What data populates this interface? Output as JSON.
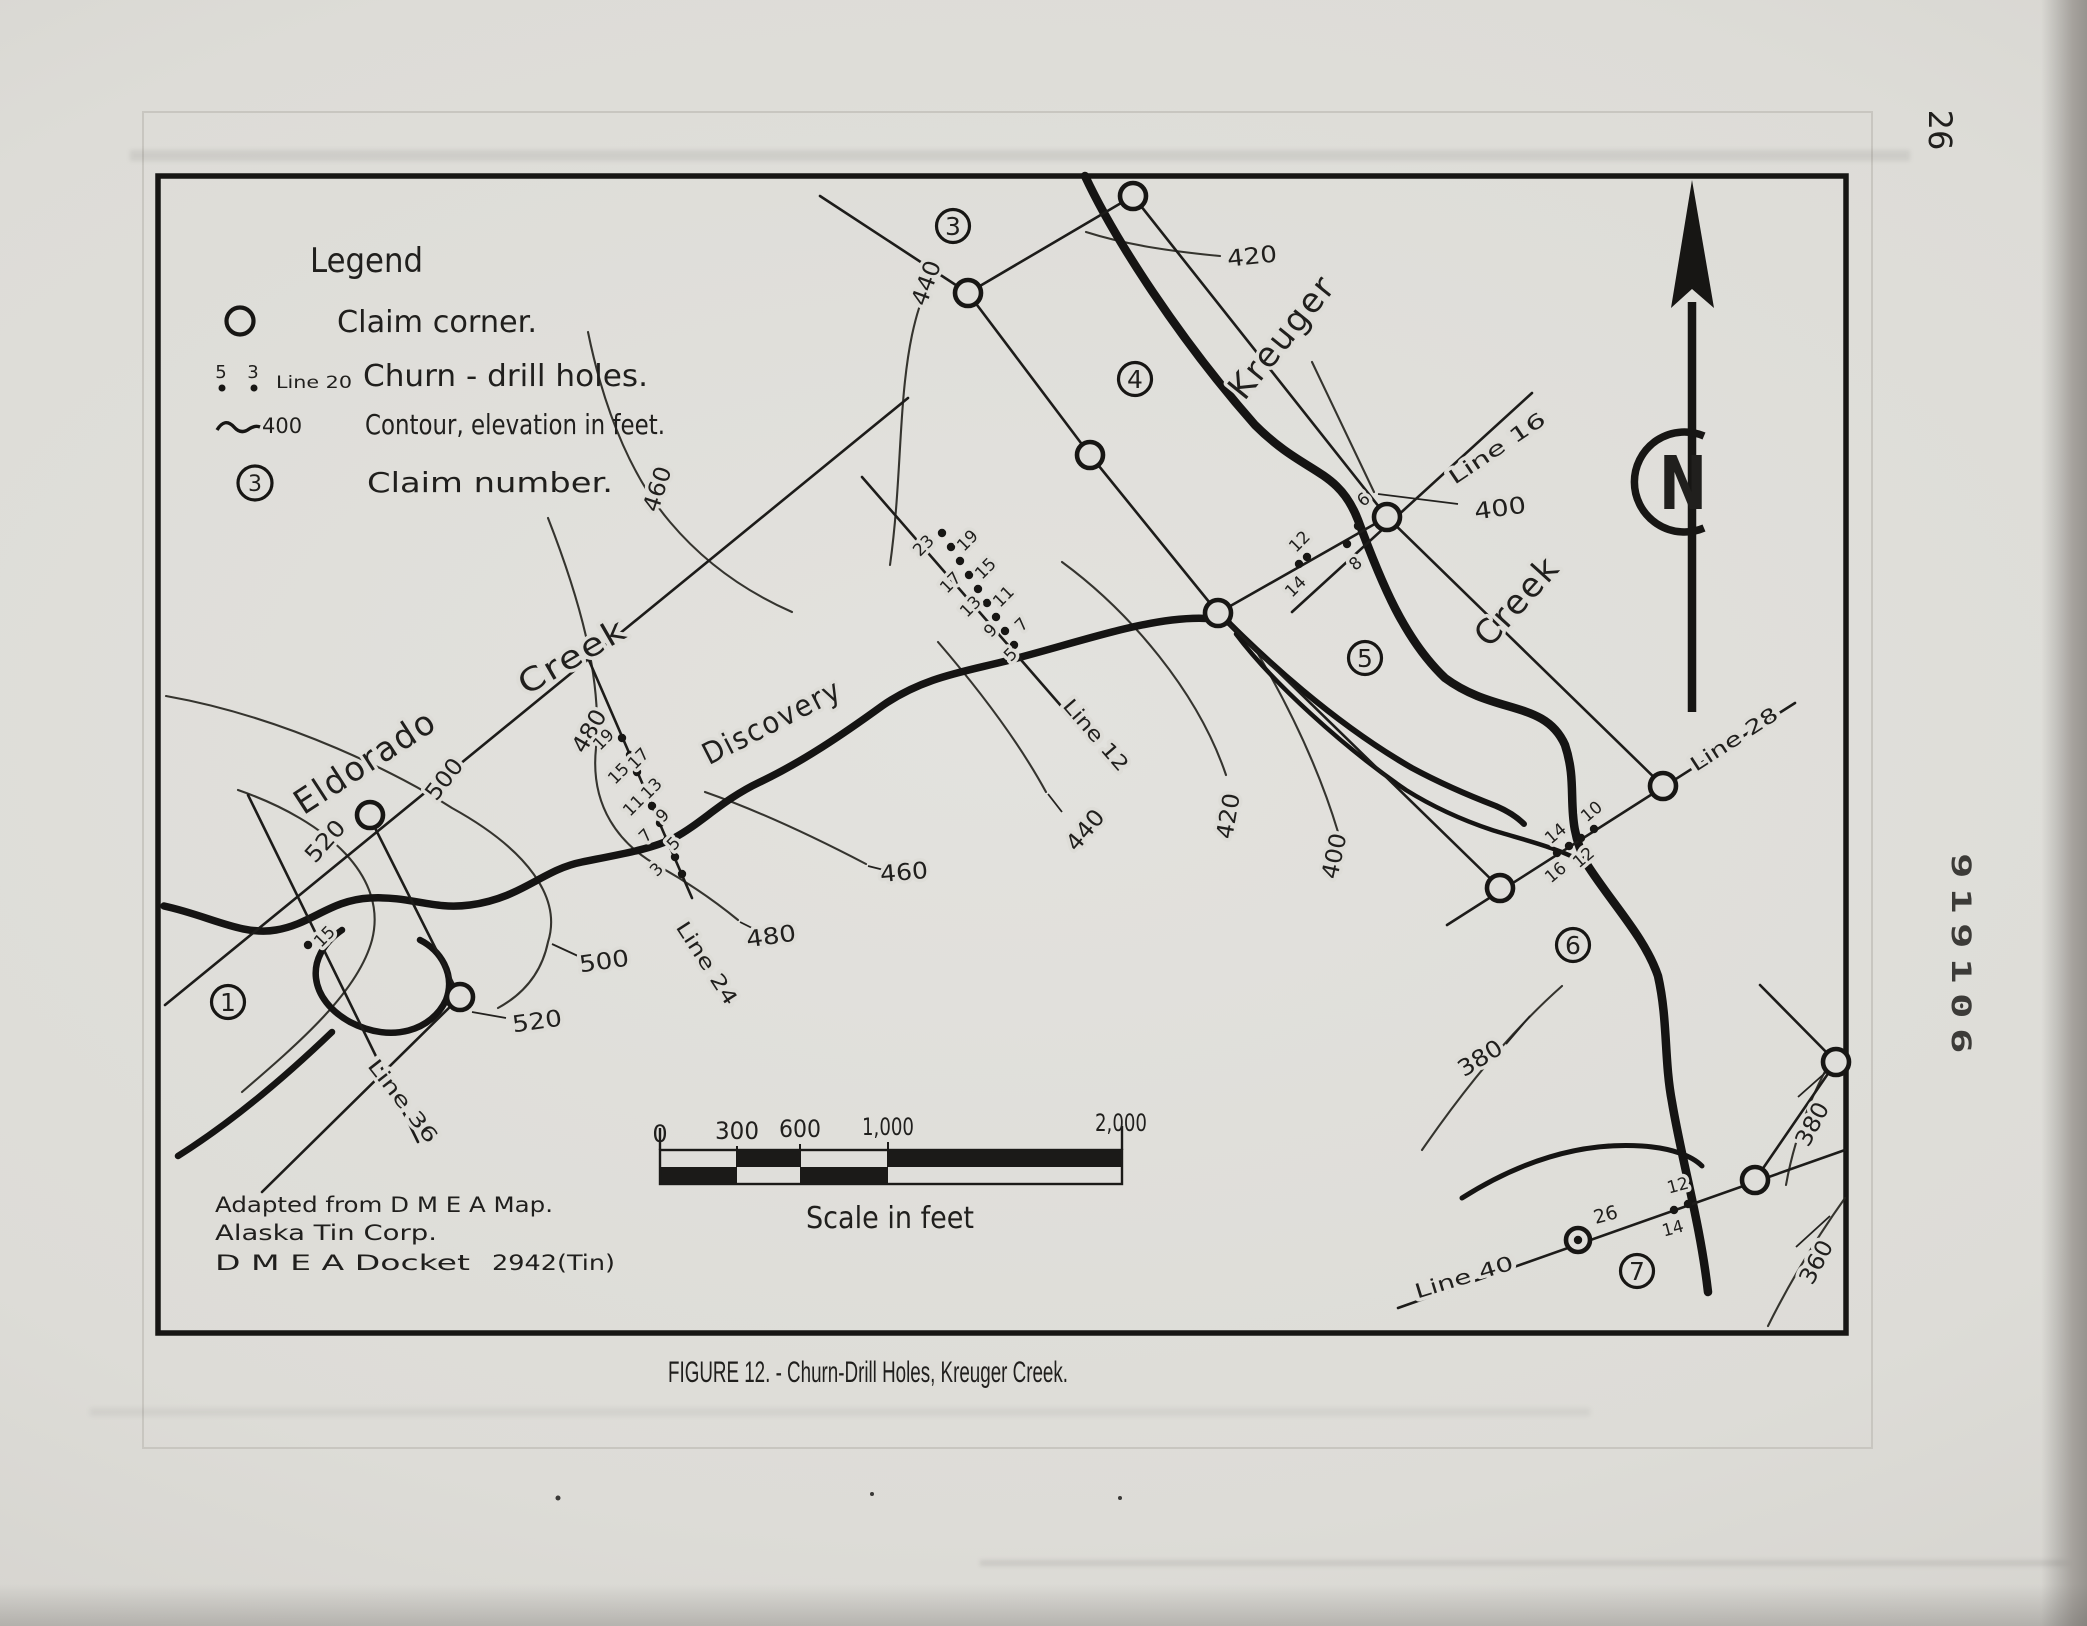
{
  "page": {
    "number": "26",
    "stamp": "919106"
  },
  "caption": "FIGURE 12. - Churn-Drill Holes, Kreuger Creek.",
  "legend": {
    "title": "Legend",
    "claim_corner_label": "Claim corner.",
    "drill_num_left": "5",
    "drill_num_right": "3",
    "drill_line_text": "Line 20",
    "drill_label": "Churn - drill holes.",
    "contour_value": "400",
    "contour_label": "Contour, elevation in feet.",
    "claim_number_symbol": "3",
    "claim_number_label": "Claim number."
  },
  "attribution": {
    "line1": "Adapted from D M E A Map.",
    "line2": "Alaska Tin Corp.",
    "line3": "D M E A Docket",
    "docket_no": "2942(Tin)"
  },
  "scalebar": {
    "ticks": [
      "0",
      "300",
      "600",
      "1,000",
      "2,000"
    ],
    "caption": "Scale in feet"
  },
  "north": "N",
  "names": {
    "eldorado": "Eldorado",
    "eldorado_creek": "Creek",
    "discovery": "Discovery",
    "kreuger": "Kreuger",
    "kreuger_creek": "Creek"
  },
  "claim_numbers": [
    "1",
    "3",
    "4",
    "5",
    "6",
    "7"
  ],
  "survey_lines": {
    "l12": "Line 12",
    "l16": "Line 16",
    "l24": "Line 24",
    "l28": "Line 28",
    "l36": "Line 36",
    "l40": "Line 40"
  },
  "contour_labels": [
    "440",
    "420",
    "460",
    "480",
    "500",
    "520",
    "520",
    "500",
    "480",
    "460",
    "440",
    "420",
    "400",
    "400",
    "380",
    "380",
    "360"
  ],
  "drill_holes": {
    "line12": [
      "23",
      "19",
      "15",
      "11",
      "7",
      "17",
      "13",
      "9",
      "5"
    ],
    "line24": [
      "19",
      "15",
      "11",
      "7",
      "3",
      "17",
      "13",
      "9",
      "5"
    ],
    "line16": [
      "6",
      "8"
    ],
    "line20": [
      "12",
      "14"
    ],
    "line28": [
      "10",
      "14",
      "12",
      "16"
    ],
    "line36": [
      "15"
    ],
    "line40": [
      "12",
      "14"
    ],
    "hole26": "26"
  }
}
